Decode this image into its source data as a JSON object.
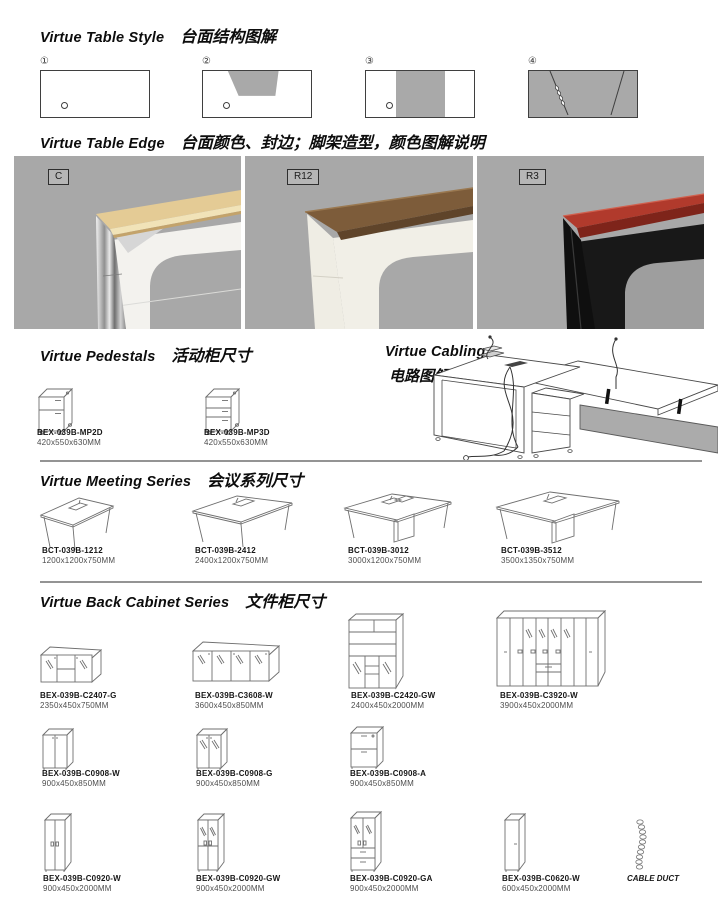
{
  "colors": {
    "diagram_gray": "#a9a9a9",
    "photo_bg": "#a8a8a8",
    "maple_top": "#e4cb95",
    "walnut_top": "#7d5c3a",
    "red_top": "#b13a2c",
    "separator": "#949494"
  },
  "table_style": {
    "title_en": "Virtue Table Style",
    "title_zh": "台面结构图解",
    "diagram_nums": [
      "①",
      "②",
      "③",
      "④"
    ]
  },
  "table_edge": {
    "title_en": "Virtue Table Edge",
    "title_zh": "台面颜色、封边；脚架造型，颜色图解说明",
    "photos": [
      {
        "label": "C"
      },
      {
        "label": "R12"
      },
      {
        "label": "R3"
      }
    ]
  },
  "pedestals": {
    "title_en": "Virtue Pedestals",
    "title_zh": "活动柜尺寸",
    "items": [
      {
        "model": "BEX-039B-MP2D",
        "dims": "420x550x630MM"
      },
      {
        "model": "BEX-039B-MP3D",
        "dims": "420x550x630MM"
      }
    ]
  },
  "cabling": {
    "title_en": "Virtue Cabling",
    "title_zh": "电路图解"
  },
  "meeting": {
    "title_en": "Virtue Meeting Series",
    "title_zh": "会议系列尺寸",
    "items": [
      {
        "model": "BCT-039B-1212",
        "dims": "1200x1200x750MM"
      },
      {
        "model": "BCT-039B-2412",
        "dims": "2400x1200x750MM"
      },
      {
        "model": "BCT-039B-3012",
        "dims": "3000x1200x750MM"
      },
      {
        "model": "BCT-039B-3512",
        "dims": "3500x1350x750MM"
      }
    ]
  },
  "back_cabinet": {
    "title_en": "Virtue Back Cabinet Series",
    "title_zh": "文件柜尺寸",
    "row1": [
      {
        "model": "BEX-039B-C2407-G",
        "dims": "2350x450x750MM"
      },
      {
        "model": "BEX-039B-C3608-W",
        "dims": "3600x450x850MM"
      },
      {
        "model": "BEX-039B-C2420-GW",
        "dims": "2400x450x2000MM"
      },
      {
        "model": "BEX-039B-C3920-W",
        "dims": "3900x450x2000MM"
      }
    ],
    "row2": [
      {
        "model": "BEX-039B-C0908-W",
        "dims": "900x450x850MM"
      },
      {
        "model": "BEX-039B-C0908-G",
        "dims": "900x450x850MM"
      },
      {
        "model": "BEX-039B-C0908-A",
        "dims": "900x450x850MM"
      }
    ],
    "row3": [
      {
        "model": "BEX-039B-C0920-W",
        "dims": "900x450x2000MM"
      },
      {
        "model": "BEX-039B-C0920-GW",
        "dims": "900x450x2000MM"
      },
      {
        "model": "BEX-039B-C0920-GA",
        "dims": "900x450x2000MM"
      },
      {
        "model": "BEX-039B-C0620-W",
        "dims": "600x450x2000MM"
      }
    ],
    "cable_duct_label": "CABLE DUCT"
  }
}
